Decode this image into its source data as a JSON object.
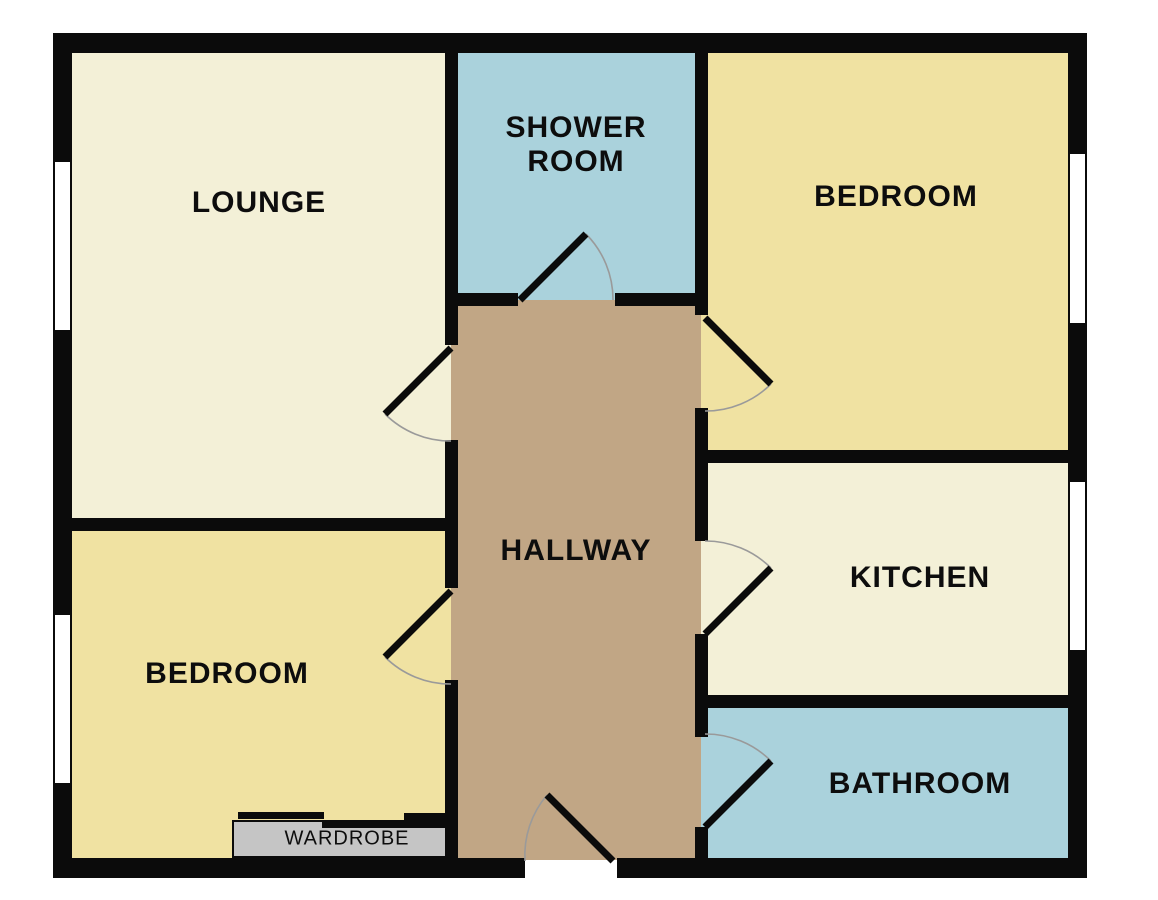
{
  "plan_title": "Flat floor plan",
  "rooms": [
    {
      "id": "lounge",
      "label": "LOUNGE",
      "color": "#F3F0D7"
    },
    {
      "id": "shower-room",
      "label": "SHOWER ROOM",
      "color": "#AAD2DC"
    },
    {
      "id": "bedroom-top-right",
      "label": "BEDROOM",
      "color": "#F0E2A2"
    },
    {
      "id": "hallway",
      "label": "HALLWAY",
      "color": "#C1A685"
    },
    {
      "id": "kitchen",
      "label": "KITCHEN",
      "color": "#F3F0D7"
    },
    {
      "id": "bedroom-bottom-left",
      "label": "BEDROOM",
      "color": "#F0E2A2"
    },
    {
      "id": "bathroom",
      "label": "BATHROOM",
      "color": "#AAD2DC"
    }
  ],
  "wardrobe": {
    "label": "WARDROBE",
    "color": "#C5C5C5"
  },
  "colors": {
    "wall": "#0b0b0b",
    "door_arc": "#9a9a9a",
    "window": "#ffffff",
    "background": "#ffffff",
    "label_text": "#0d0d0d"
  }
}
